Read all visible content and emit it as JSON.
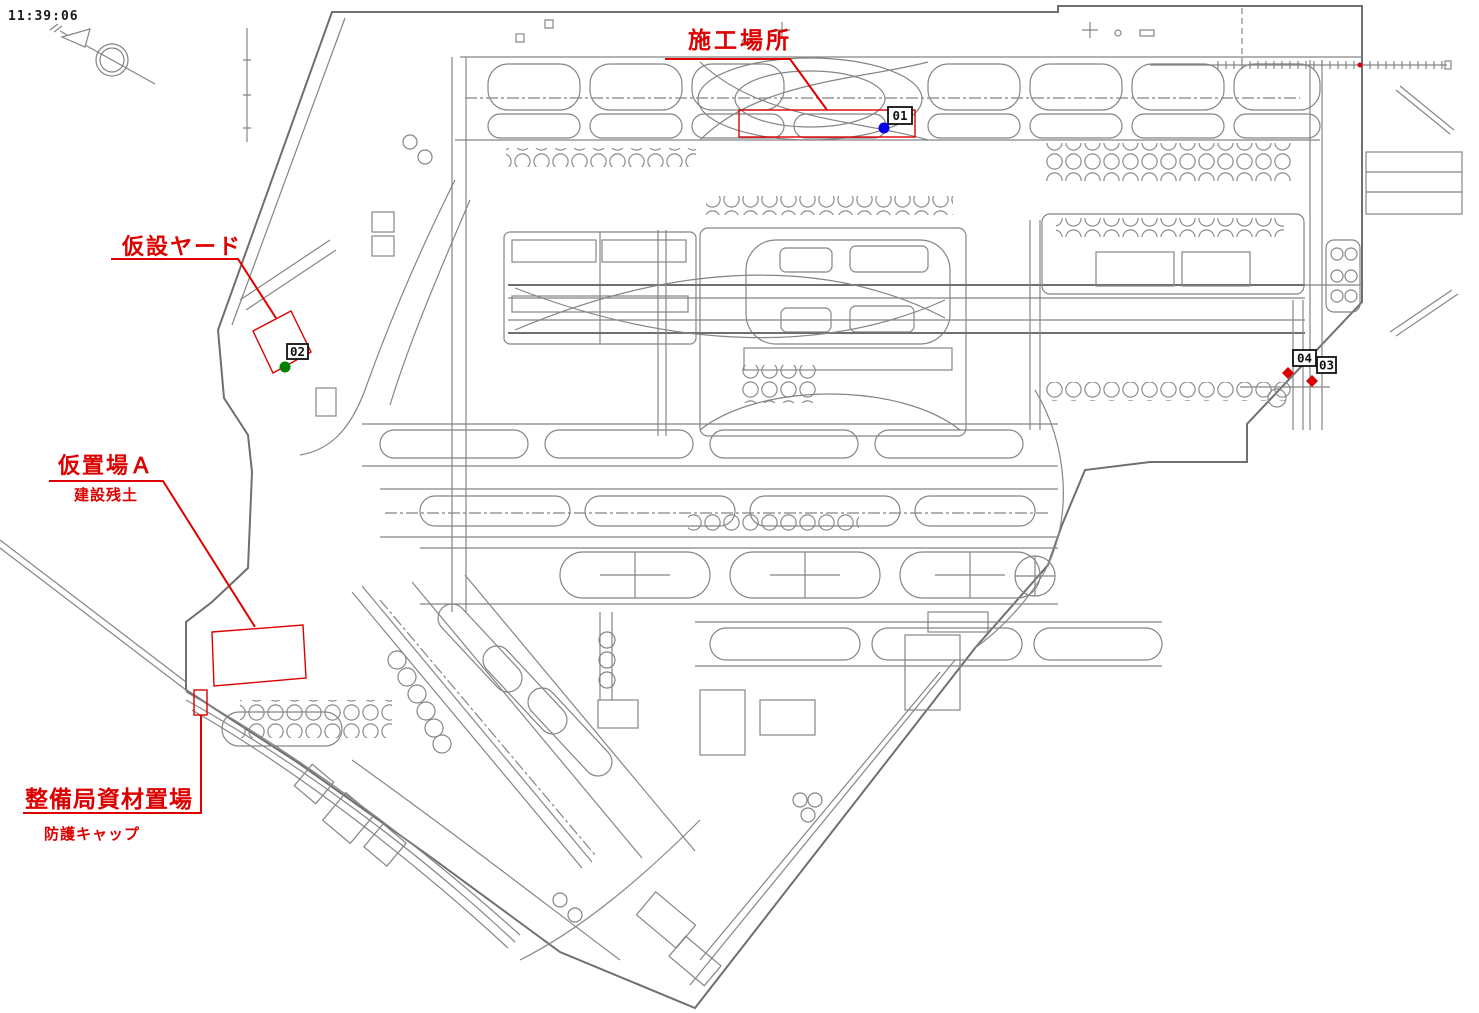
{
  "header": {
    "timestamp": "11:39:06"
  },
  "annotations": {
    "construction_site": {
      "label": "施工場所",
      "marker": "01"
    },
    "temporary_yard": {
      "label": "仮設ヤード",
      "marker": "02"
    },
    "temporary_storage_a": {
      "label": "仮置場Ａ",
      "sublabel": "建設残土"
    },
    "maintenance_bureau_storage": {
      "label": "整備局資材置場",
      "sublabel": "防護キャップ"
    }
  },
  "markers": [
    {
      "id": "01",
      "dot_color": "#0000ee"
    },
    {
      "id": "02",
      "dot_color": "#008000"
    },
    {
      "id": "03",
      "dot_color": "#dd0000"
    },
    {
      "id": "04",
      "dot_color": "#dd0000"
    }
  ],
  "icons": {
    "north_arrow": "double-circle compass with arrow"
  },
  "colors": {
    "annotation_red": "#dd0000",
    "map_linework": "#858585",
    "background": "#ffffff",
    "marker_box_border": "#111111"
  }
}
